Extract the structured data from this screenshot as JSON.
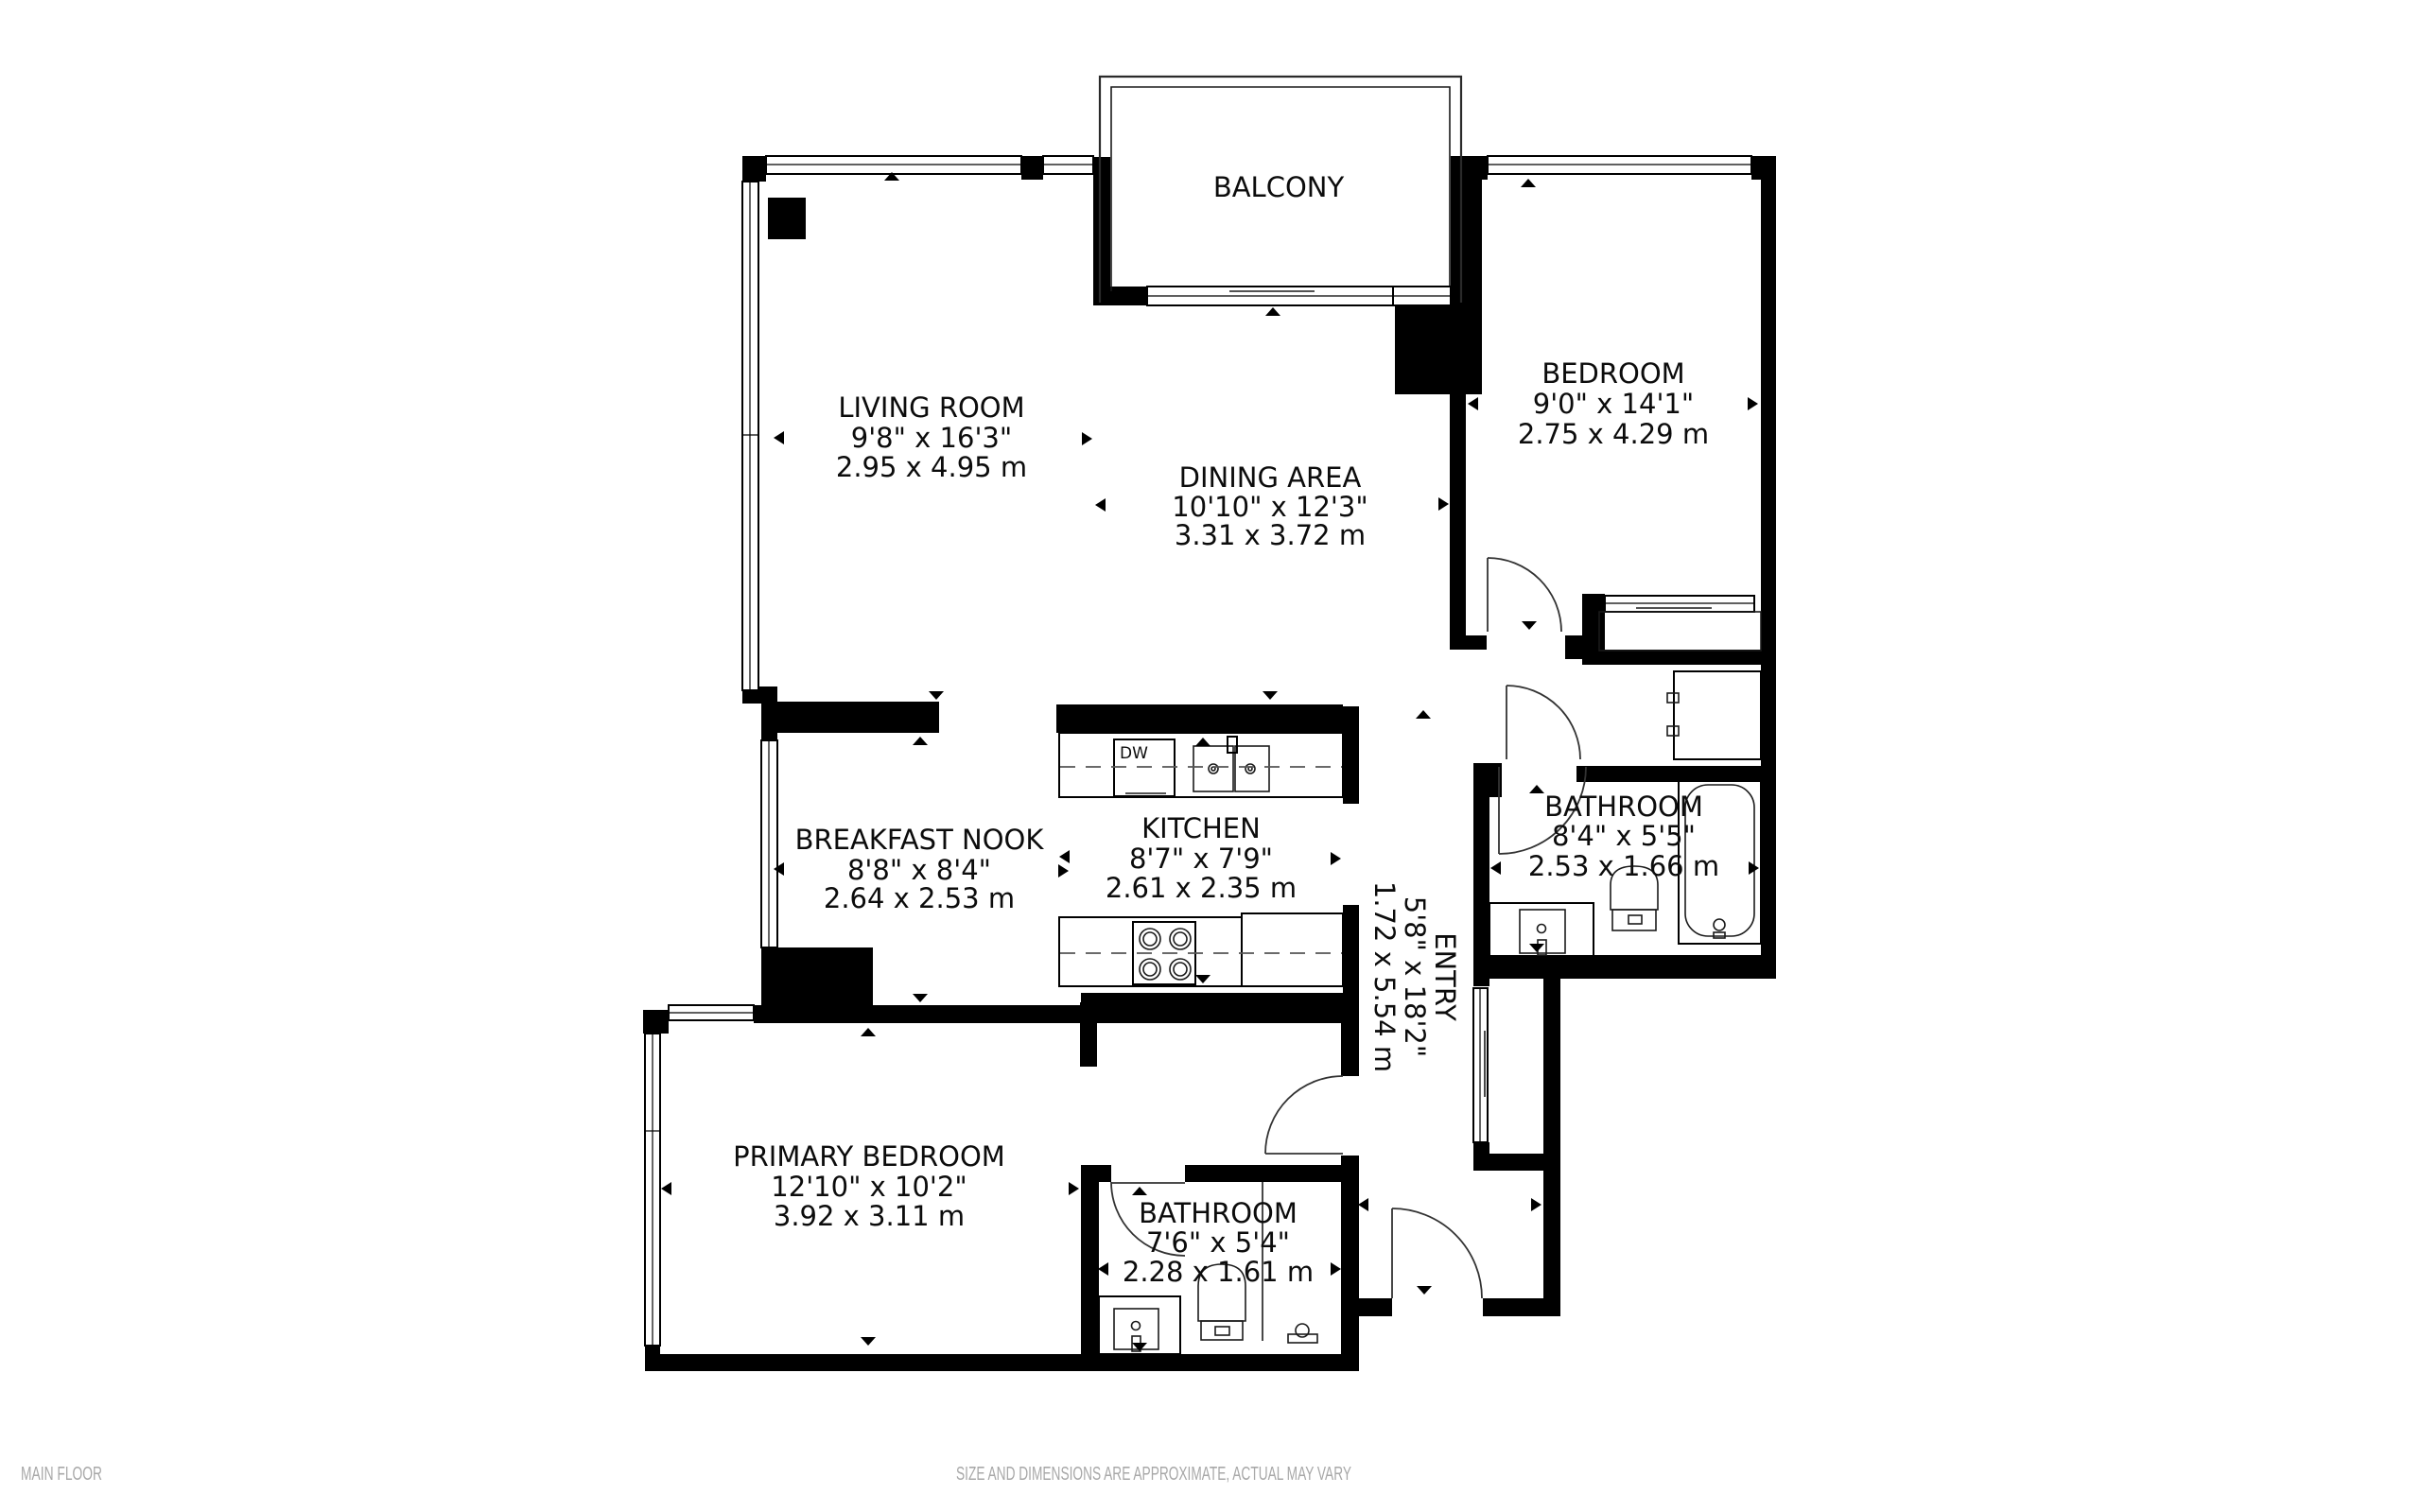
{
  "floor_label": "MAIN FLOOR",
  "disclaimer": "SIZE AND DIMENSIONS ARE APPROXIMATE, ACTUAL MAY VARY",
  "colors": {
    "walls": "#000000",
    "background": "#ffffff",
    "footer_text": "#a8a8a8"
  },
  "labels": {
    "dishwasher": "DW"
  },
  "rooms": [
    {
      "id": "balcony",
      "name": "BALCONY",
      "imperial": "",
      "metric": ""
    },
    {
      "id": "living-room",
      "name": "LIVING ROOM",
      "imperial": "9'8\" x 16'3\"",
      "metric": "2.95 x 4.95 m"
    },
    {
      "id": "dining-area",
      "name": "DINING AREA",
      "imperial": "10'10\" x 12'3\"",
      "metric": "3.31 x 3.72 m"
    },
    {
      "id": "bedroom",
      "name": "BEDROOM",
      "imperial": "9'0\" x 14'1\"",
      "metric": "2.75 x 4.29 m"
    },
    {
      "id": "breakfast-nook",
      "name": "BREAKFAST NOOK",
      "imperial": "8'8\" x 8'4\"",
      "metric": "2.64 x 2.53 m"
    },
    {
      "id": "kitchen",
      "name": "KITCHEN",
      "imperial": "8'7\" x 7'9\"",
      "metric": "2.61 x 2.35 m"
    },
    {
      "id": "bathroom-main",
      "name": "BATHROOM",
      "imperial": "8'4\" x 5'5\"",
      "metric": "2.53 x 1.66 m"
    },
    {
      "id": "entry",
      "name": "ENTRY",
      "imperial": "5'8\" x 18'2\"",
      "metric": "1.72 x 5.54 m"
    },
    {
      "id": "primary-bedroom",
      "name": "PRIMARY BEDROOM",
      "imperial": "12'10\" x 10'2\"",
      "metric": "3.92 x 3.11 m"
    },
    {
      "id": "bathroom-ensuite",
      "name": "BATHROOM",
      "imperial": "7'6\" x 5'4\"",
      "metric": "2.28 x 1.61 m"
    }
  ]
}
